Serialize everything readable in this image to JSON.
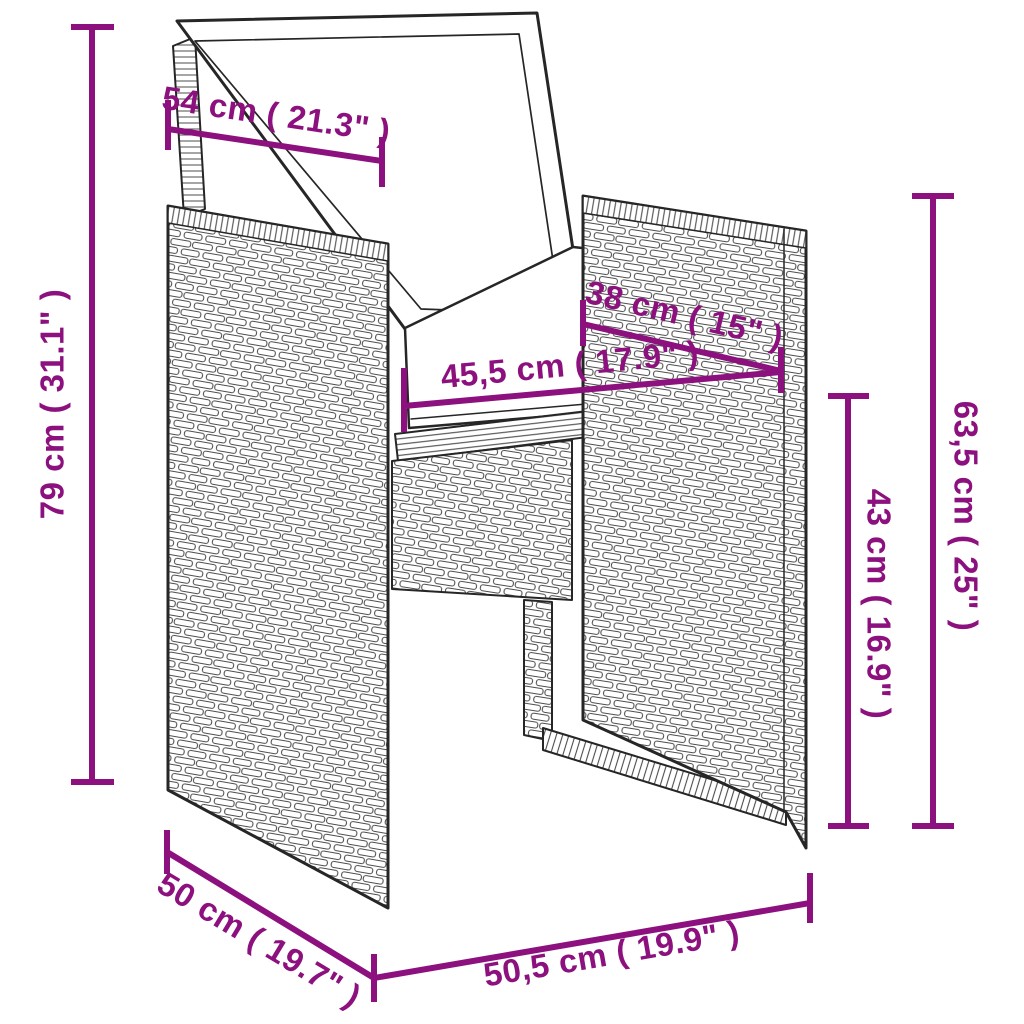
{
  "image_type": "product-dimension-diagram",
  "product": {
    "description": "poly-rattan-garden-armchair-with-back-and-seat-cushions"
  },
  "colors": {
    "dimension": "#8C107E",
    "outline": "#262626",
    "background": "#FFFFFF"
  },
  "dims": {
    "backrest_width": {
      "label": "54 cm ( 21.3\" )",
      "cm": 54,
      "inch": 21.3
    },
    "total_height": {
      "label": "79 cm ( 31.1\" )",
      "cm": 79,
      "inch": 31.1
    },
    "seat_depth": {
      "label": "38 cm ( 15\" )",
      "cm": 38,
      "inch": 15
    },
    "seat_width": {
      "label": "45,5 cm ( 17.9\" )",
      "cm": 45.5,
      "inch": 17.9
    },
    "side_height": {
      "label": "63,5 cm ( 25\" )",
      "cm": 63.5,
      "inch": 25
    },
    "seat_height": {
      "label": "43 cm ( 16.9\" )",
      "cm": 43,
      "inch": 16.9
    },
    "side_depth": {
      "label": "50 cm ( 19.7\" )",
      "cm": 50,
      "inch": 19.7
    },
    "front_width": {
      "label": "50,5 cm ( 19.9\" )",
      "cm": 50.5,
      "inch": 19.9
    }
  }
}
